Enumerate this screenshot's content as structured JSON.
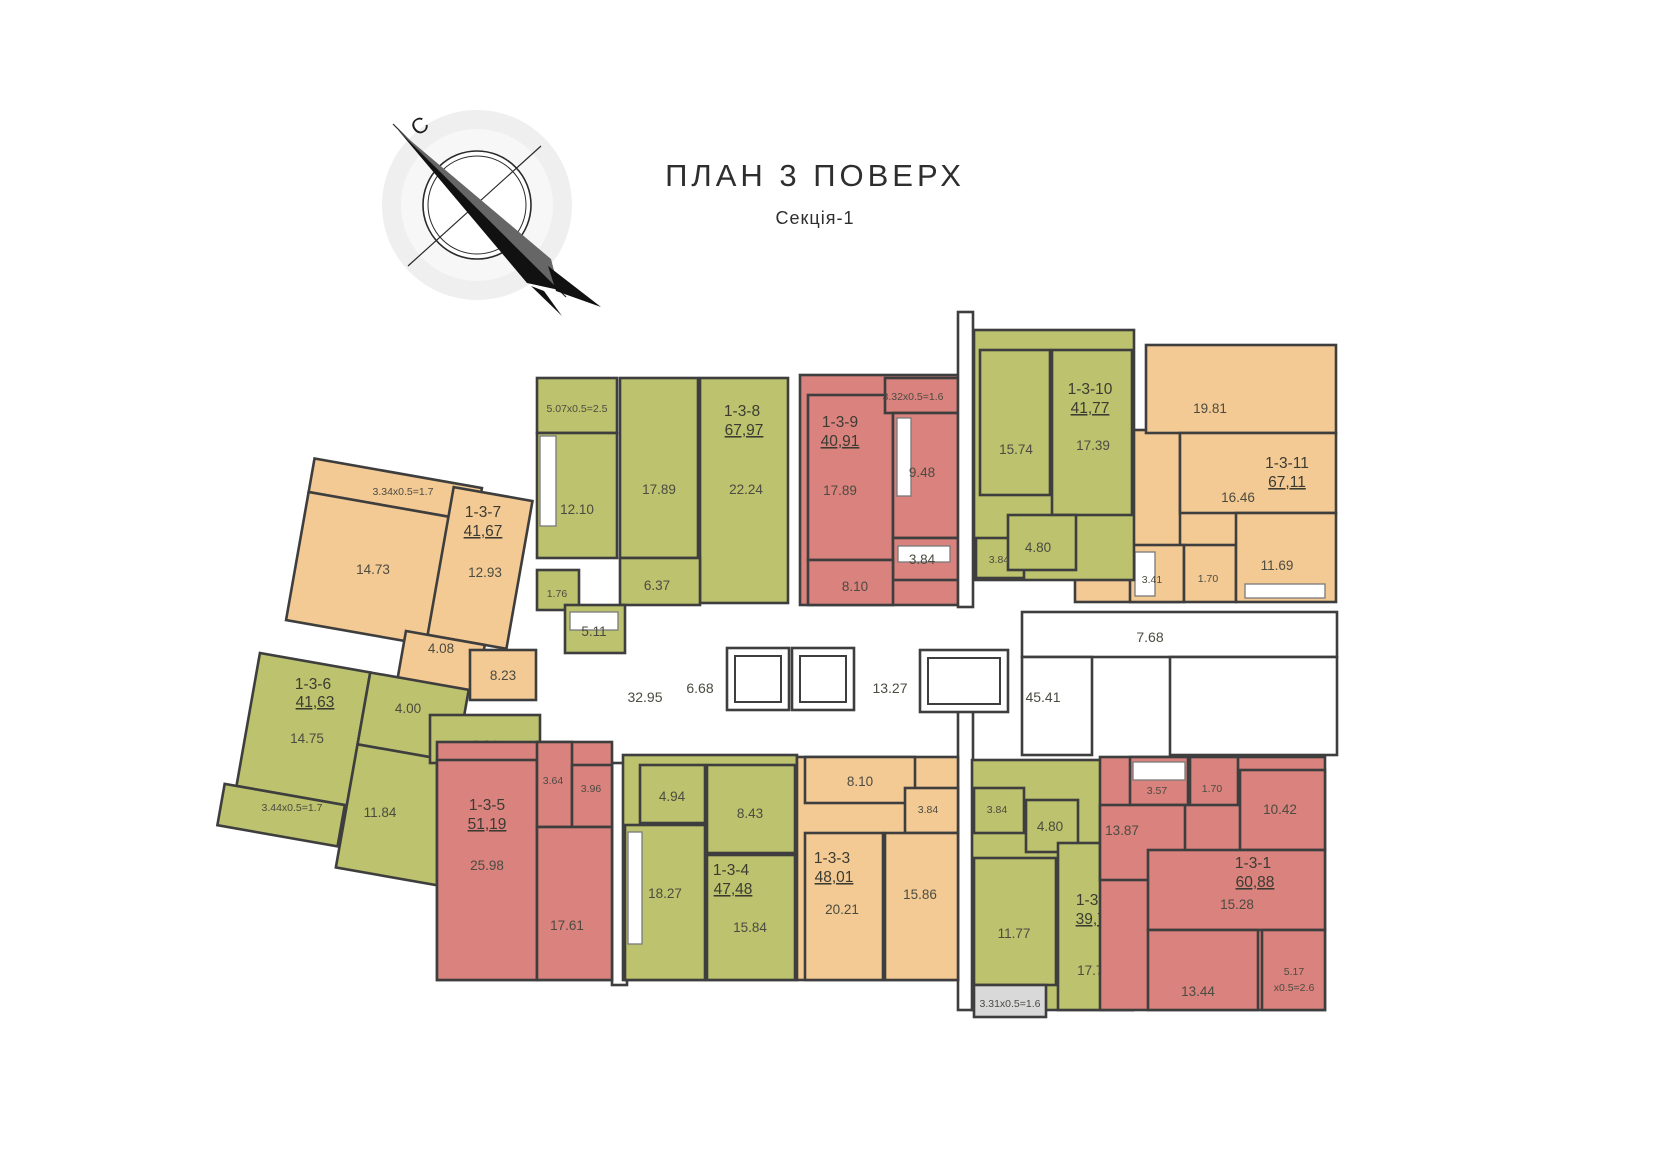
{
  "header": {
    "title": "ПЛАН 3 ПОВЕРХ",
    "subtitle": "Секція-1"
  },
  "compass": {
    "north": "С"
  },
  "colors": {
    "green": "#bcc26d",
    "orange": "#f4ca94",
    "red": "#d9827e",
    "balcony_gray": "#d9d9d9",
    "wall": "#3e3e3e",
    "label_text": "#4b4b41"
  },
  "apartments": {
    "a1": {
      "id": "1-3-1",
      "area": "60,88",
      "rooms": {
        "r13_87": "13.87",
        "r3_57": "3.57",
        "r1_70": "1.70",
        "r10_42": "10.42",
        "r15_28": "15.28",
        "r13_44": "13.44"
      },
      "balcony_l1": "5.17",
      "balcony_l2": "x0.5=2.6"
    },
    "a2": {
      "id": "1-3-2",
      "area": "39,79",
      "rooms": {
        "r3_84": "3.84",
        "r4_80": "4.80",
        "r11_77": "11.77",
        "r17_78": "17.78"
      },
      "balcony": "3.31x0.5=1.6"
    },
    "a3": {
      "id": "1-3-3",
      "area": "48,01",
      "rooms": {
        "r8_10": "8.10",
        "r3_84": "3.84",
        "r20_21": "20.21",
        "r15_86": "15.86"
      }
    },
    "a4": {
      "id": "1-3-4",
      "area": "47,48",
      "rooms": {
        "r4_94": "4.94",
        "r8_43": "8.43",
        "r18_27": "18.27",
        "r15_84": "15.84"
      }
    },
    "a5": {
      "id": "1-3-5",
      "area": "51,19",
      "rooms": {
        "r25_98": "25.98",
        "r17_61": "17.61",
        "r3_64": "3.64",
        "r3_96": "3.96"
      }
    },
    "a6": {
      "id": "1-3-6",
      "area": "41,63",
      "rooms": {
        "r14_75": "14.75",
        "r4_00": "4.00",
        "r9_34": "9.34",
        "r11_84": "11.84"
      },
      "balcony": "3.44x0.5=1.7"
    },
    "a7": {
      "id": "1-3-7",
      "area": "41,67",
      "rooms": {
        "r14_73": "14.73",
        "r12_93": "12.93",
        "r4_08": "4.08",
        "r8_23": "8.23"
      },
      "balcony": "3.34x0.5=1.7"
    },
    "a8": {
      "id": "1-3-8",
      "area": "67,97",
      "rooms": {
        "r12_10": "12.10",
        "r17_89": "17.89",
        "r22_24": "22.24",
        "r6_37": "6.37",
        "r1_76": "1.76",
        "r5_11": "5.11"
      },
      "balcony": "5.07x0.5=2.5"
    },
    "a9": {
      "id": "1-3-9",
      "area": "40,91",
      "rooms": {
        "r17_89": "17.89",
        "r9_48": "9.48",
        "r3_84": "3.84",
        "r8_10": "8.10"
      },
      "balcony": "3.32x0.5=1.6"
    },
    "a10": {
      "id": "1-3-10",
      "area": "41,77",
      "rooms": {
        "r15_74": "15.74",
        "r17_39": "17.39",
        "r4_80": "4.80",
        "r3_84": "3.84"
      }
    },
    "a11": {
      "id": "1-3-11",
      "area": "67,11",
      "rooms": {
        "r19_81": "19.81",
        "r16_46": "16.46",
        "r14_04": "14.04",
        "r3_41": "3.41",
        "r1_70": "1.70",
        "r11_69": "11.69"
      }
    }
  },
  "common": {
    "c32_95": "32.95",
    "c6_68": "6.68",
    "c13_27": "13.27",
    "c45_41": "45.41",
    "c7_68": "7.68"
  }
}
